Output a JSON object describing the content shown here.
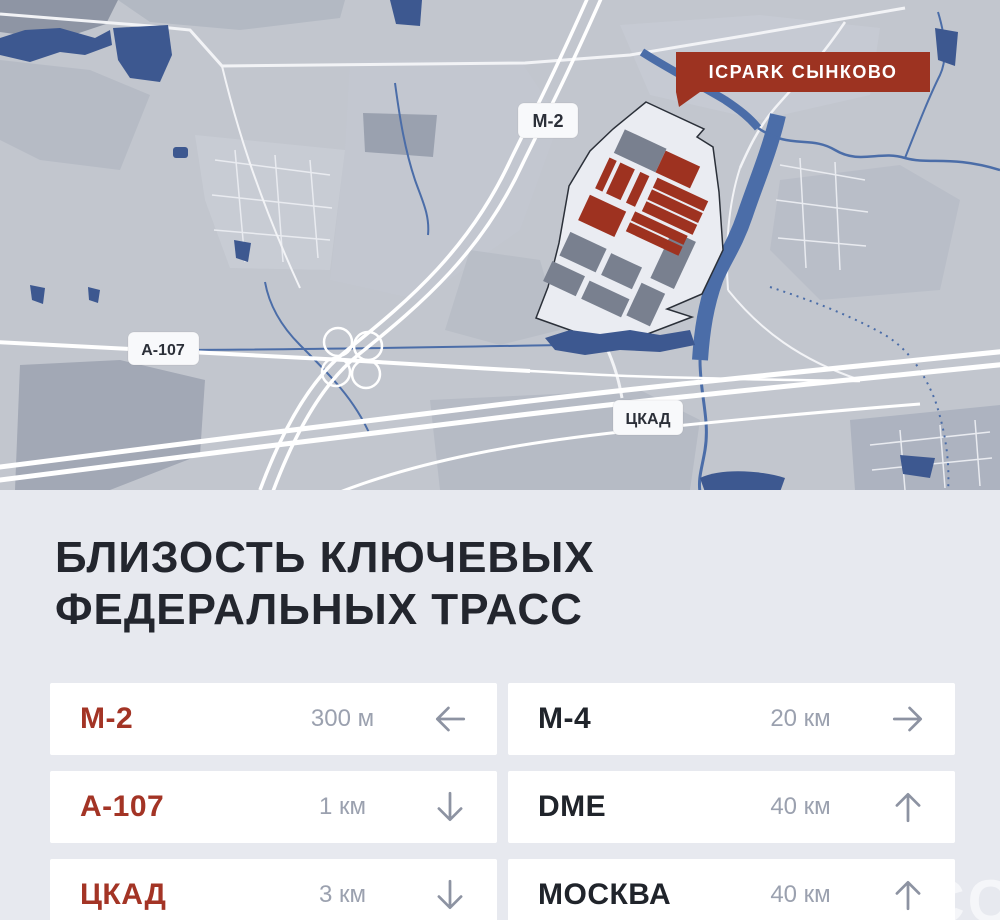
{
  "map": {
    "badge": {
      "label": "ICPARK СЫНКОВО"
    },
    "road_labels": [
      {
        "label": "М-2"
      },
      {
        "label": "А-107"
      },
      {
        "label": "ЦКАД"
      }
    ]
  },
  "section": {
    "title_line1": "БЛИЗОСТЬ КЛЮЧЕВЫХ",
    "title_line2": "ФЕДЕРАЛЬНЫХ ТРАСС",
    "routes": [
      {
        "name": "М-2",
        "distance": "300 м",
        "direction": "left",
        "highlight": true
      },
      {
        "name": "М-4",
        "distance": "20 км",
        "direction": "right",
        "highlight": false
      },
      {
        "name": "А-107",
        "distance": "1 км",
        "direction": "down",
        "highlight": true
      },
      {
        "name": "DME",
        "distance": "40 км",
        "direction": "up",
        "highlight": false
      },
      {
        "name": "ЦКАД",
        "distance": "3 км",
        "direction": "down",
        "highlight": true
      },
      {
        "name": "МОСКВА",
        "distance": "40 км",
        "direction": "up",
        "highlight": false
      }
    ]
  },
  "watermark": "CC",
  "colors": {
    "badge_red": "#9d3321",
    "building_red": "#9e3220",
    "name_accent": "#a33425",
    "name_dark": "#20242b",
    "title": "#23262e",
    "distance_gray": "#9ba1af",
    "arrow_gray": "#8d93a2",
    "card_bg": "#ffffff",
    "sheet_bg": "#e7e9ef",
    "map_bg": "#c2c6ce",
    "water_blue": "#3d5890"
  }
}
